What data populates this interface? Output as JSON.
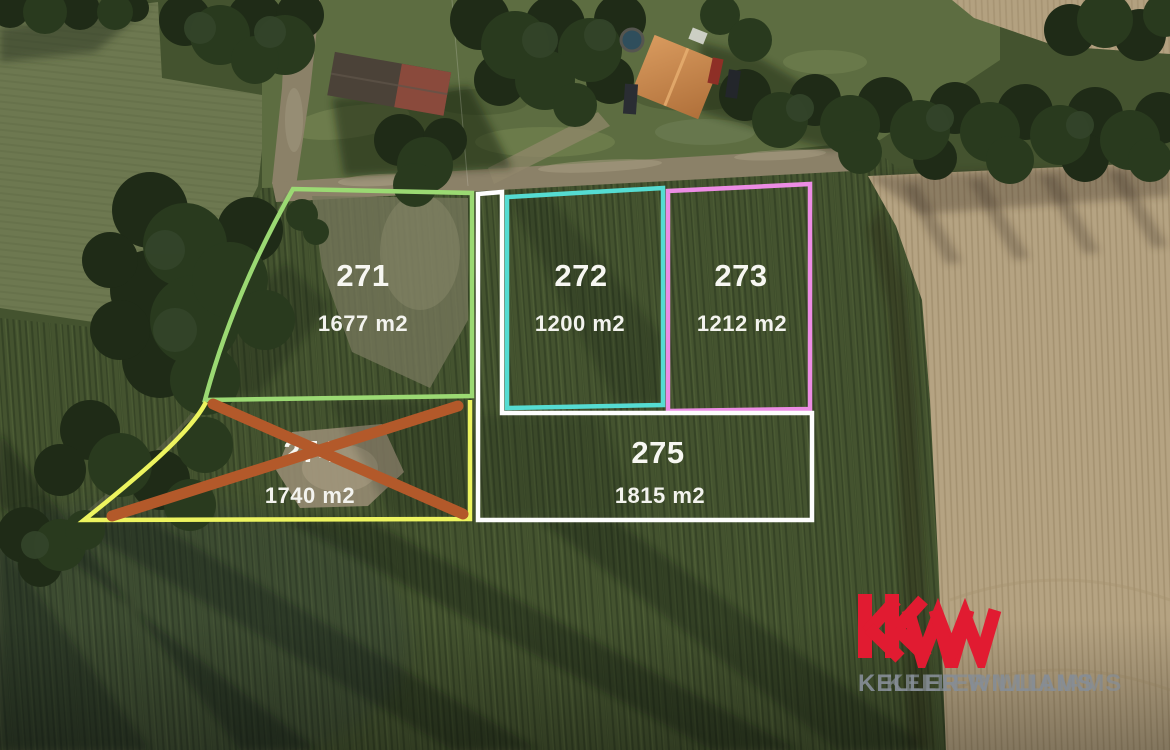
{
  "scene": {
    "type": "aerial-photo-with-parcel-overlay",
    "field_green": "#44532f",
    "plowed_field_tan": "#b5a382",
    "label_text_color": "#f7f7f2"
  },
  "plots": [
    {
      "label": "271",
      "area": "1677 m2",
      "border_color": "#9bd973",
      "crossed_out": false
    },
    {
      "label": "272",
      "area": "1200 m2",
      "border_color": "#55dcd2",
      "crossed_out": false
    },
    {
      "label": "273",
      "area": "1212 m2",
      "border_color": "#ec8ce4",
      "crossed_out": false
    },
    {
      "label": "274",
      "area": "1740 m2",
      "border_color": "#edf45f",
      "crossed_out": true,
      "cross_color": "#b3592a"
    },
    {
      "label": "275",
      "area": "1815 m2",
      "border_color": "#fdfdfd",
      "crossed_out": false
    }
  ],
  "watermark": {
    "logo": "kw",
    "brand_line": "KELLER WILLIAMS",
    "logo_color": "#e11b31",
    "text_color": "#868d96"
  }
}
